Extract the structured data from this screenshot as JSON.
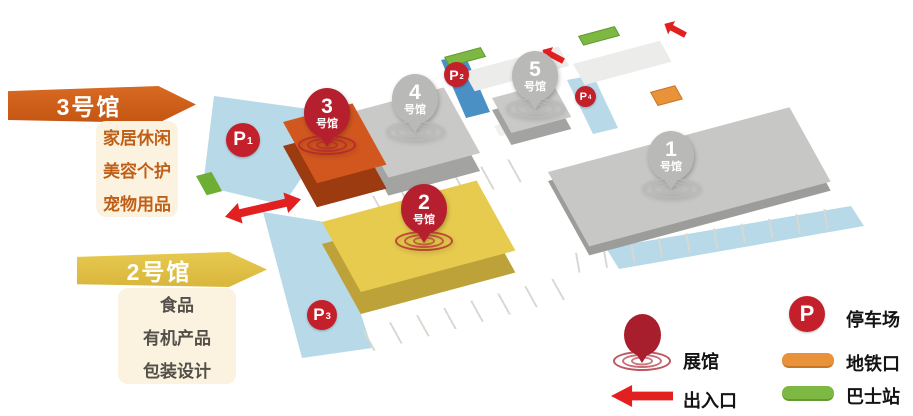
{
  "callouts": [
    {
      "title": "3号馆",
      "items": [
        "家居休闲",
        "美容个护",
        "宠物用品"
      ],
      "banner_color": "#d2641e",
      "text_color": "#c06018"
    },
    {
      "title": "2号馆",
      "items": [
        "食品",
        "有机产品",
        "包装设计"
      ],
      "banner_color": "#e2c24a",
      "text_color": "#53504a"
    }
  ],
  "halls": [
    {
      "number": "1",
      "suffix": "号馆",
      "top_color": "#c7c7c5",
      "side_color": "#9c9c9a",
      "pin_color": "#b9b9b7"
    },
    {
      "number": "2",
      "suffix": "号馆",
      "top_color": "#e7cb4e",
      "side_color": "#bda23a",
      "pin_color": "#b6202e"
    },
    {
      "number": "3",
      "suffix": "号馆",
      "top_color": "#d2571f",
      "side_color": "#9c3a10",
      "pin_color": "#b6202e"
    },
    {
      "number": "4",
      "suffix": "号馆",
      "top_color": "#c9c9c7",
      "side_color": "#a3a3a1",
      "pin_color": "#b9b9b7"
    },
    {
      "number": "5",
      "suffix": "号馆",
      "top_color": "#c9c9c7",
      "side_color": "#a3a3a1",
      "pin_color": "#b9b9b7"
    }
  ],
  "parking": [
    {
      "label": "P",
      "sub": "1"
    },
    {
      "label": "P",
      "sub": "2"
    },
    {
      "label": "P",
      "sub": "3"
    },
    {
      "label": "P",
      "sub": "4"
    }
  ],
  "legend": {
    "items": [
      {
        "icon": "pin-icon",
        "label": "展馆"
      },
      {
        "icon": "arrow-icon",
        "label": "出入口"
      },
      {
        "icon": "parking-icon",
        "label": "停车场",
        "badge": "P"
      },
      {
        "icon": "metro-icon",
        "label": "地铁口"
      },
      {
        "icon": "bus-icon",
        "label": "巴士站"
      }
    ]
  },
  "colors": {
    "road": "#b7d9e8",
    "metro_strip": "#4a90c5",
    "arrow_red": "#e32020",
    "pin_red": "#b6202e",
    "pin_gray": "#b9b9b7",
    "parking_badge": "#c4202c",
    "metro_mark": "#e8923a",
    "bus_mark": "#7db843"
  }
}
